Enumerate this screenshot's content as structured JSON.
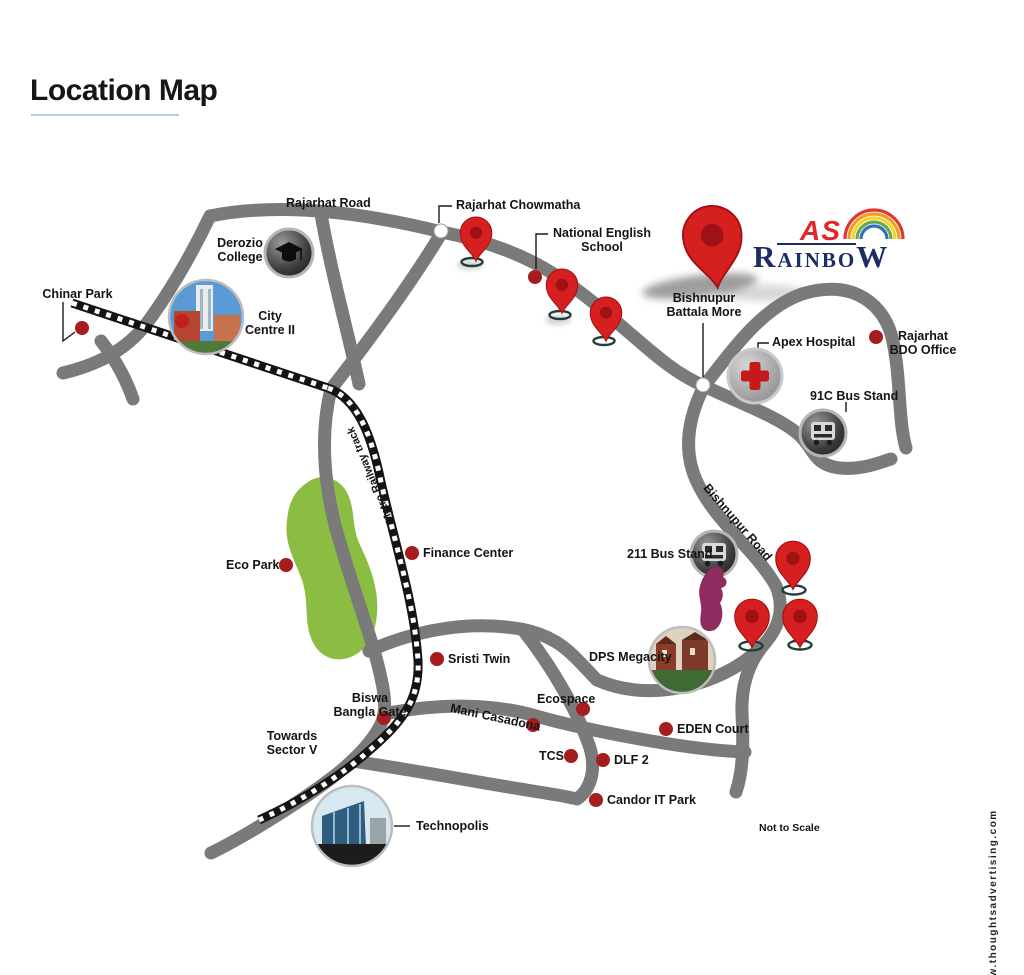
{
  "title": "Location Map",
  "logo": {
    "as": "AS",
    "r": "R",
    "mid": "AINBO",
    "w": "W"
  },
  "road_labels": {
    "rajarhat": "Rajarhat Road",
    "metro": "Metro Railway track",
    "bishnupur": "Bishnupur Road"
  },
  "places": {
    "chinar_park": "Chinar Park",
    "derozio": "Derozio\nCollege",
    "city_centre": "City\nCentre II",
    "chowmatha": "Rajarhat Chowmatha",
    "nes": "National English\nSchool",
    "battala": "Bishnupur\nBattala More",
    "apex": "Apex Hospital",
    "bdo": "Rajarhat\nBDO Office",
    "bus91c": "91C Bus Stand",
    "finance": "Finance Center",
    "eco_park": "Eco Park",
    "bus211": "211 Bus Stand",
    "sristi": "Sristi Twin",
    "dps": "DPS Megacity",
    "biswa": "Biswa\nBangla Gate",
    "mani": "Mani Casadona",
    "ecospace": "Ecospace",
    "eden": "EDEN Court",
    "tcs": "TCS",
    "dlf2": "DLF 2",
    "candor": "Candor IT Park",
    "sector5": "Towards\nSector V",
    "technopolis": "Technopolis"
  },
  "notes": {
    "not_to_scale": "Not to Scale",
    "website": "www.thoughtsadvertising.com"
  },
  "colors": {
    "pin_red": "#d6201f",
    "dot_red": "#a51d1d",
    "road_gray": "#7a7a7a",
    "park_green": "#8cbd43",
    "underline_blue": "#a9d5e2",
    "logo_red": "#e2262c",
    "logo_navy": "#1c2d63"
  }
}
